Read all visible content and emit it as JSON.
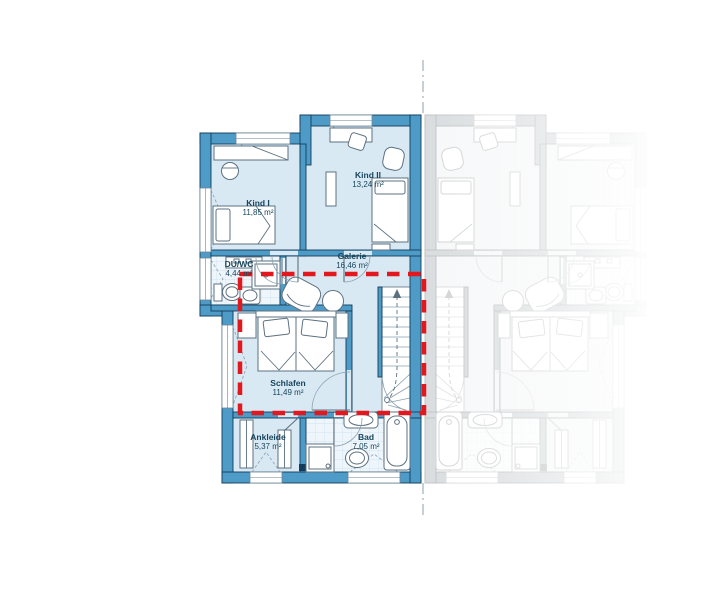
{
  "plan": {
    "type": "floor-plan",
    "floor": "upper-floor",
    "rooms": [
      {
        "id": "kind1",
        "name": "Kind I",
        "area": "11,85 m²"
      },
      {
        "id": "kind2",
        "name": "Kind II",
        "area": "13,24 m²"
      },
      {
        "id": "galerie",
        "name": "Galerie",
        "area": "16,46 m²"
      },
      {
        "id": "duwc",
        "name": "DU/WC",
        "area": "4,44 m²"
      },
      {
        "id": "schlafen",
        "name": "Schlafen",
        "area": "11,49 m²"
      },
      {
        "id": "ankleide",
        "name": "Ankleide",
        "area": "5,37 m²"
      },
      {
        "id": "bad",
        "name": "Bad",
        "area": "7,05 m²"
      }
    ],
    "marker": {
      "shape": "dashed-rectangle",
      "color": "#e2181f"
    },
    "adjacent_unit": "mirrored-ghost"
  },
  "colors": {
    "wall_blue": "#4e9bc8",
    "room_fill": "#d9e9f4",
    "accent_red": "#e2181f",
    "outline": "#123c5a",
    "label_text": "#17465c"
  }
}
